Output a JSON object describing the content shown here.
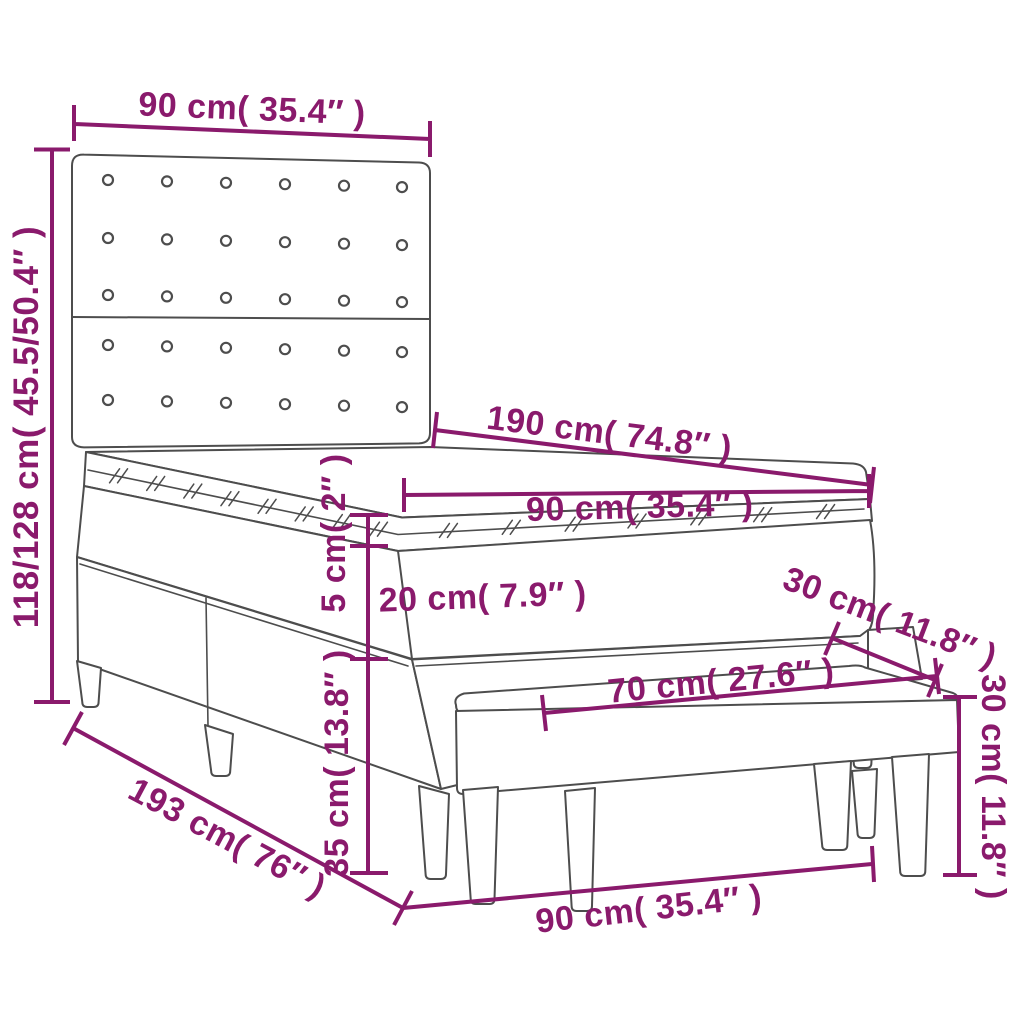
{
  "figure": {
    "name": "box-spring-bed-with-headboard-and-bench-dimension-diagram"
  },
  "colors": {
    "dimension": "#8a1a6c",
    "line_art": "#4d4d4d",
    "background": "#ffffff"
  },
  "dimensions": [
    {
      "id": "headboard_width",
      "label": "90 cm( 35.4″ )"
    },
    {
      "id": "overall_height",
      "label": "118/128 cm( 45.5/50.4″ )"
    },
    {
      "id": "mattress_length",
      "label": "190 cm( 74.8″ )"
    },
    {
      "id": "mattress_width",
      "label": "90 cm( 35.4″ )"
    },
    {
      "id": "topper_thickness",
      "label": "5 cm( 2″ )"
    },
    {
      "id": "mattress_thickness",
      "label": "20 cm( 7.9″ )"
    },
    {
      "id": "bench_depth",
      "label": "30 cm( 11.8″ )"
    },
    {
      "id": "bench_length",
      "label": "70 cm( 27.6″ )"
    },
    {
      "id": "bench_height",
      "label": "30 cm( 11.8″ )"
    },
    {
      "id": "base_height",
      "label": "35 cm( 13.8″ )"
    },
    {
      "id": "bed_length",
      "label": "193 cm( 76″ )"
    },
    {
      "id": "bench_width",
      "label": "90 cm( 35.4″ )"
    }
  ]
}
